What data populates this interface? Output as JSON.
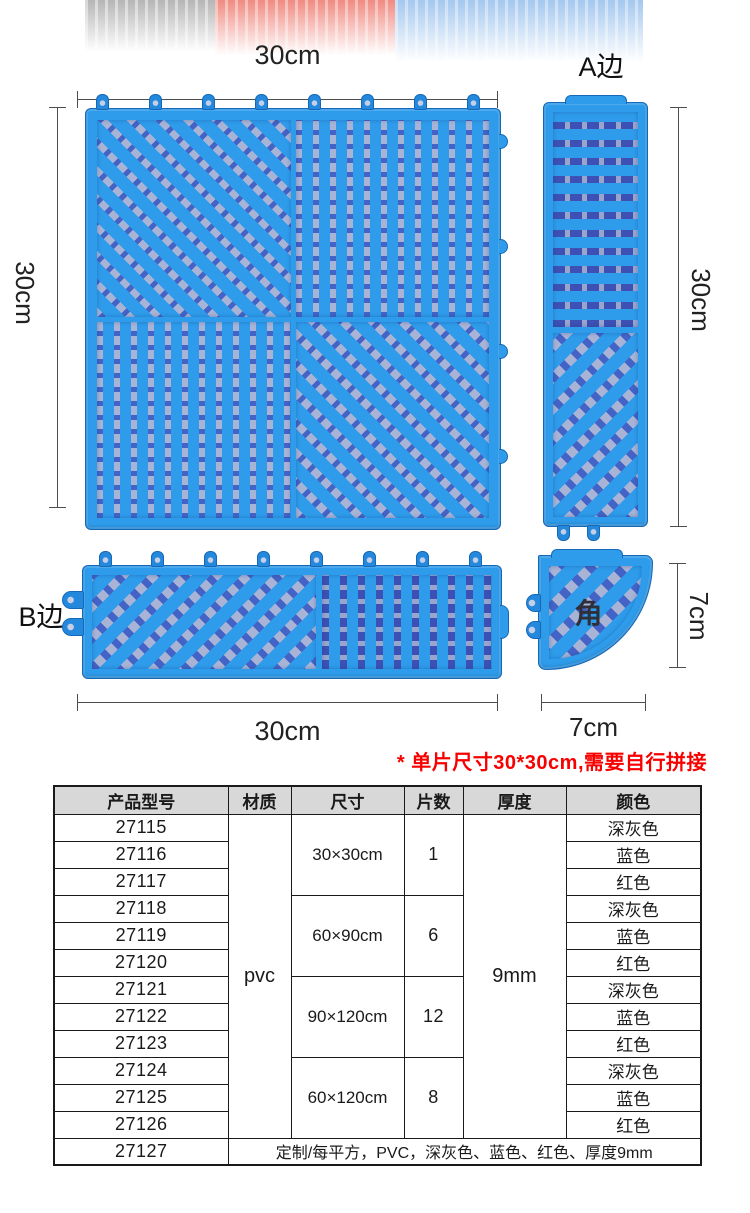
{
  "colors": {
    "mat_blue": "#2E9CEA",
    "mat_edge_blue": "#1568B8",
    "hole_light": "#A9B3D6",
    "hole_dark": "#4463C6",
    "note_red": "#F80000",
    "table_header_bg": "#D8D8D8"
  },
  "diagram": {
    "main_mat": {
      "width_label": "30cm",
      "height_label": "30cm"
    },
    "a_edge": {
      "label": "A边",
      "height_label": "30cm"
    },
    "b_edge": {
      "label": "B边",
      "width_label": "30cm"
    },
    "corner": {
      "label": "角",
      "width_label": "7cm",
      "height_label": "7cm"
    }
  },
  "note": "* 单片尺寸30*30cm,需要自行拼接",
  "table": {
    "headers": [
      "产品型号",
      "材质",
      "尺寸",
      "片数",
      "厚度",
      "颜色"
    ],
    "material": "pvc",
    "thickness": "9mm",
    "groups": [
      {
        "size": "30×30cm",
        "pieces": "1",
        "rows": [
          {
            "model": "27115",
            "color": "深灰色"
          },
          {
            "model": "27116",
            "color": "蓝色"
          },
          {
            "model": "27117",
            "color": "红色"
          }
        ]
      },
      {
        "size": "60×90cm",
        "pieces": "6",
        "rows": [
          {
            "model": "27118",
            "color": "深灰色"
          },
          {
            "model": "27119",
            "color": "蓝色"
          },
          {
            "model": "27120",
            "color": "红色"
          }
        ]
      },
      {
        "size": "90×120cm",
        "pieces": "12",
        "rows": [
          {
            "model": "27121",
            "color": "深灰色"
          },
          {
            "model": "27122",
            "color": "蓝色"
          },
          {
            "model": "27123",
            "color": "红色"
          }
        ]
      },
      {
        "size": "60×120cm",
        "pieces": "8",
        "rows": [
          {
            "model": "27124",
            "color": "深灰色"
          },
          {
            "model": "27125",
            "color": "蓝色"
          },
          {
            "model": "27126",
            "color": "红色"
          }
        ]
      }
    ],
    "custom_row": {
      "model": "27127",
      "description": "定制/每平方，PVC，深灰色、蓝色、红色、厚度9mm"
    }
  }
}
